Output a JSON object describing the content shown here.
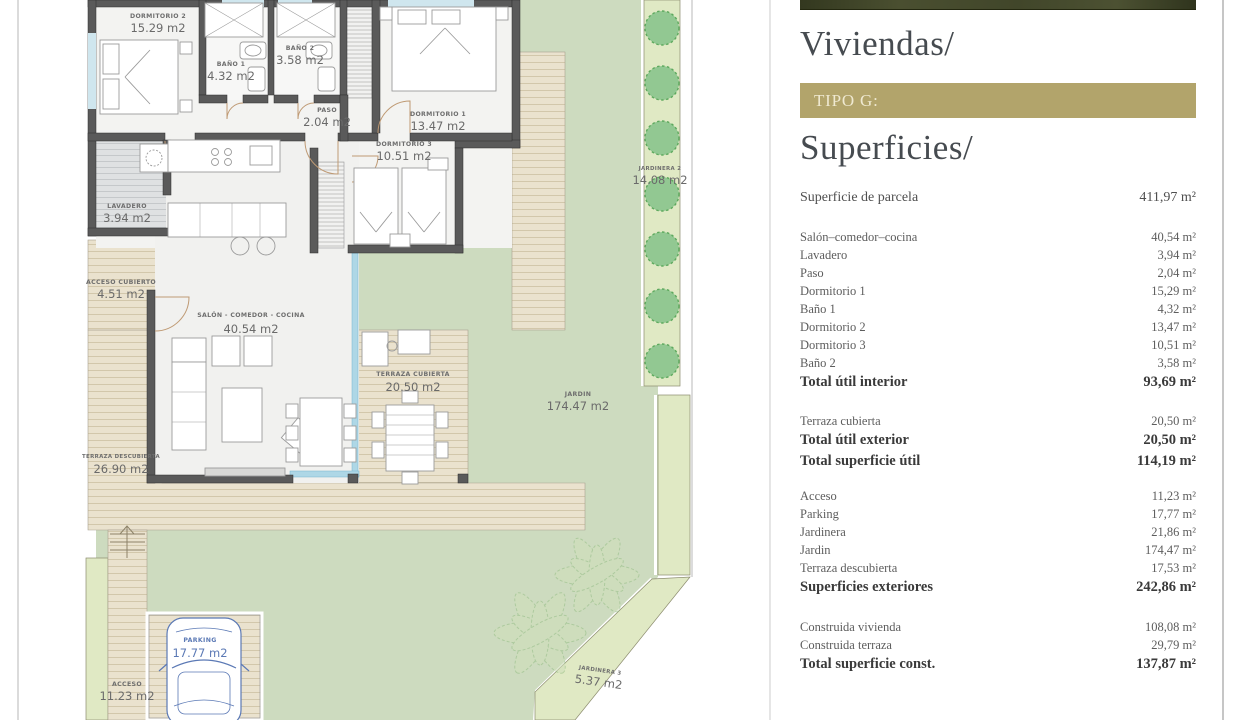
{
  "panel": {
    "title": "Viviendas/",
    "type_label": "TIPO G:",
    "subtitle": "Superficies/",
    "parcel_row": {
      "label": "Superficie de parcela",
      "value": "411,97 m²"
    },
    "sections": [
      {
        "rows": [
          {
            "label": "Salón–comedor–cocina",
            "value": "40,54 m²"
          },
          {
            "label": "Lavadero",
            "value": "3,94 m²"
          },
          {
            "label": "Paso",
            "value": "2,04 m²"
          },
          {
            "label": "Dormitorio 1",
            "value": "15,29 m²"
          },
          {
            "label": "Baño 1",
            "value": "4,32 m²"
          },
          {
            "label": "Dormitorio 2",
            "value": "13,47 m²"
          },
          {
            "label": "Dormitorio 3",
            "value": "10,51 m²"
          },
          {
            "label": "Baño 2",
            "value": "3,58 m²"
          },
          {
            "label": "Total útil interior",
            "value": "93,69 m²"
          }
        ]
      },
      {
        "rows": [
          {
            "label": "Terraza cubierta",
            "value": "20,50 m²"
          },
          {
            "label": "Total útil exterior",
            "value": "20,50 m²"
          },
          {
            "label": "Total superficie útil",
            "value": "114,19 m²"
          }
        ]
      },
      {
        "rows": [
          {
            "label": "Acceso",
            "value": "11,23 m²"
          },
          {
            "label": "Parking",
            "value": "17,77 m²"
          },
          {
            "label": "Jardinera",
            "value": "21,86 m²"
          },
          {
            "label": "Jardin",
            "value": "174,47 m²"
          },
          {
            "label": "Terraza descubierta",
            "value": "17,53 m²"
          },
          {
            "label": "Superficies exteriores",
            "value": "242,86 m²"
          }
        ]
      },
      {
        "rows": [
          {
            "label": "Construida vivienda",
            "value": "108,08 m²"
          },
          {
            "label": "Construida terraza",
            "value": "29,79 m²"
          },
          {
            "label": "Total superficie const.",
            "value": "137,87 m²"
          }
        ]
      }
    ]
  },
  "plan": {
    "rooms": [
      {
        "name": "DORMITORIO 2",
        "area": "15.29 m2"
      },
      {
        "name": "BAÑO 1",
        "area": "4.32 m2"
      },
      {
        "name": "BAÑO 2",
        "area": "3.58 m2"
      },
      {
        "name": "PASO",
        "area": "2.04 m2"
      },
      {
        "name": "DORMITORIO 1",
        "area": "13.47 m2"
      },
      {
        "name": "DORMITORIO 3",
        "area": "10.51 m2"
      },
      {
        "name": "LAVADERO",
        "area": "3.94 m2"
      },
      {
        "name": "ACCESO CUBIERTO",
        "area": "4.51 m2"
      },
      {
        "name": "SALÓN - COMEDOR - COCINA",
        "area": "40.54 m2"
      },
      {
        "name": "TERRAZA CUBIERTA",
        "area": "20.50 m2"
      },
      {
        "name": "TERRAZA DESCUBIERTA",
        "area": "26.90 m2"
      },
      {
        "name": "JARDIN",
        "area": "174.47 m2"
      },
      {
        "name": "JARDINERA 2",
        "area": "14.08 m2"
      },
      {
        "name": "JARDINERA 3",
        "area": "5.37 m2"
      },
      {
        "name": "PARKING",
        "area": "17.77 m2"
      },
      {
        "name": "ACCESO",
        "area": "11.23 m2"
      }
    ]
  }
}
